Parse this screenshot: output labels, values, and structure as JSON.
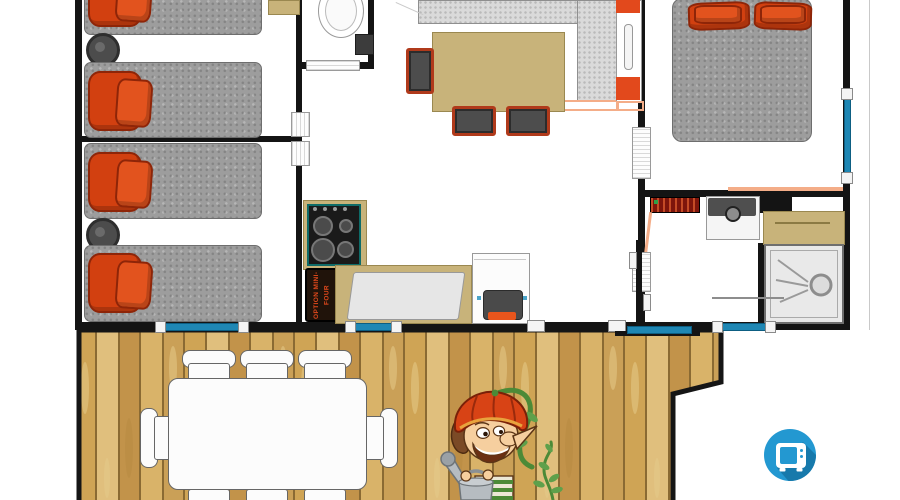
{
  "meta": {
    "type": "floor-plan",
    "style": "top-down mobile-home plan with terrace"
  },
  "labels": {
    "mini_oven_option": "OPTION MINI-FOUR"
  },
  "rooms": [
    {
      "id": "bedroom-1",
      "items": [
        "single-bed",
        "single-bed",
        "bedside-table"
      ]
    },
    {
      "id": "bedroom-2",
      "items": [
        "single-bed",
        "single-bed",
        "bedside-table"
      ]
    },
    {
      "id": "wc",
      "items": [
        "toilet"
      ]
    },
    {
      "id": "kitchen-living-room",
      "items": [
        "worktop",
        "gas-hob",
        "sink",
        "mini-oven-option-cabinet",
        "stove",
        "fridge",
        "dining-table",
        "dining-chairs-x3"
      ]
    },
    {
      "id": "master-bedroom",
      "items": [
        "double-bed"
      ]
    },
    {
      "id": "shower-room",
      "items": [
        "towel-radiator",
        "washbasin",
        "vanity-counter",
        "shower"
      ]
    },
    {
      "id": "terrace",
      "items": [
        "wood-deck",
        "outdoor-table",
        "outdoor-chairs-x8"
      ]
    }
  ],
  "badges": {
    "tv": {
      "icon": "tv-icon",
      "background": "#2398d1"
    }
  },
  "mascot": {
    "name": "gardener-elf-mascot",
    "hat_color": "#d84315",
    "props": [
      "watering-can",
      "climbing-vine"
    ]
  },
  "colors": {
    "wall": "#141414",
    "mattress": "#9d9d9d",
    "pillow": "#d24010",
    "window": "#1f87b4",
    "worktop": "#dadada",
    "table": "#c8b37a",
    "deck": "#d2a85c",
    "accent_orange": "#e2491c"
  }
}
